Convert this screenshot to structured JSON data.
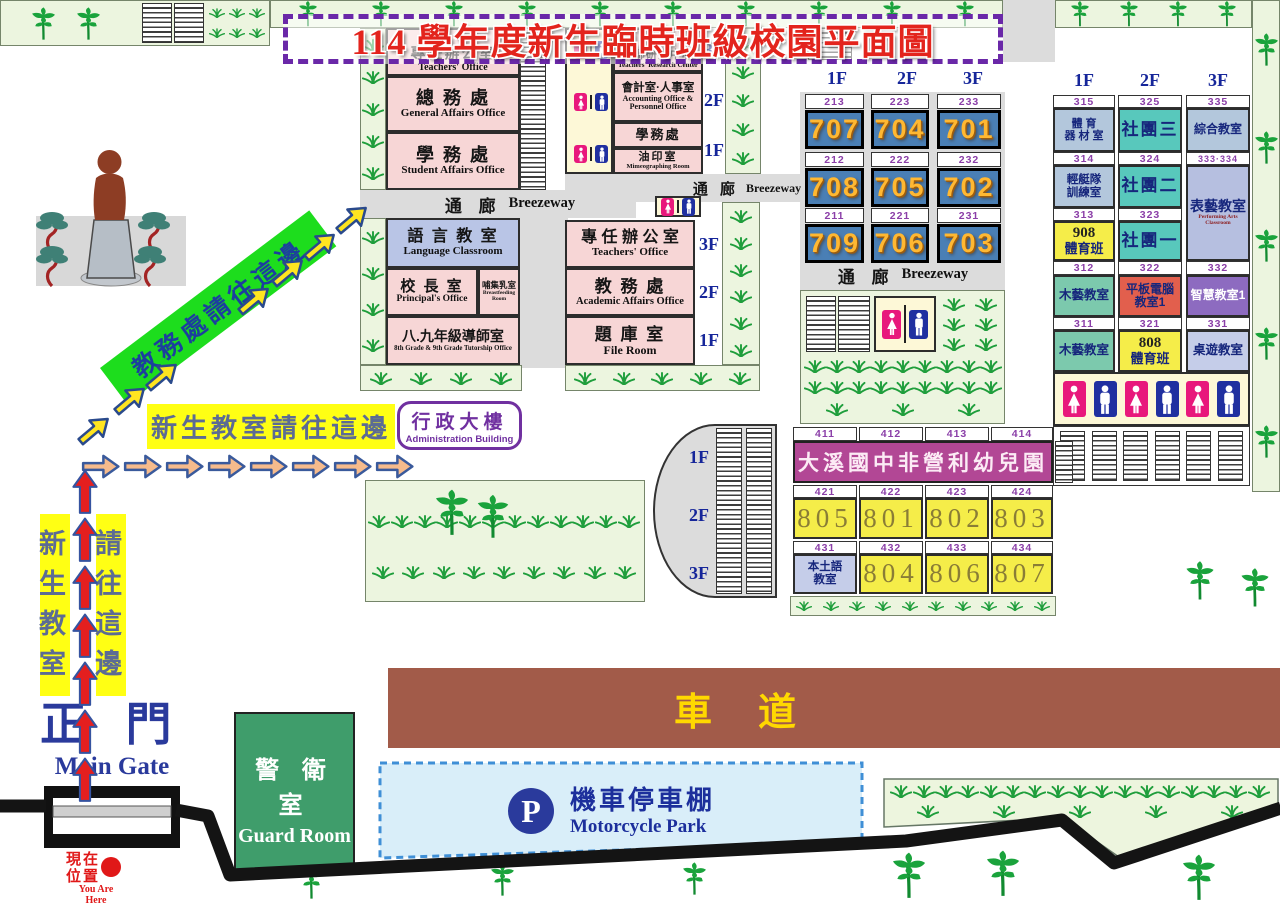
{
  "title": "114 學年度新生臨時班級校園平面圖",
  "corridor": {
    "zh": "通 廊",
    "en": "Breezeway"
  },
  "colors": {
    "title_red": "#e3241d",
    "title_border_purple": "#6a28a8",
    "room_pink": "#f7d6d6",
    "room_periwinkle": "#b9c5e6",
    "lawn_green": "#ecf5df",
    "grass_green": "#1f9e3c",
    "corridor_gray": "#dcdcdc",
    "class_cell_blue": "#4a7fb5",
    "class_cell_number_orange": "#ffb832",
    "room_number_purple": "#8b3fa8",
    "floor_label_navy": "#16269a",
    "cell_teal": "#58c8bc",
    "cell_bluegray": "#b3c7dc",
    "cell_yellow": "#f5ed49",
    "cell_green": "#7cc9ad",
    "cell_red": "#e25f4d",
    "cell_purple": "#8d6bc0",
    "cell_lavender": "#c5cde9",
    "kindergarten_purple": "#b24795",
    "guard_green": "#3f9d6b",
    "road_brown": "#a25b49",
    "road_text_yellow": "#ffd800",
    "park_bg_blue": "#d9eef9",
    "park_border_blue": "#3f8fd6",
    "park_text_navy": "#1c2f9c",
    "banner_green": "#1ddd1d",
    "banner_yellow": "#ffff14",
    "wc_female_pink": "#e8187c",
    "wc_male_blue": "#2030a0",
    "arrow_red": "#e41f1f",
    "arrow_orange": "#f6bb8c",
    "arrow_yellow": "#ffe520",
    "you_are_here_red": "#e01818"
  },
  "buildingA": {
    "r1": {
      "zh": "專任辦公室",
      "en": "Teachers' Office"
    },
    "r2": {
      "zh": "總 務 處",
      "en": "General Affairs Office"
    },
    "r3": {
      "zh": "學 務 處",
      "en": "Student Affairs Office"
    }
  },
  "buildingC": {
    "r1": {
      "zh": "教師研究中心",
      "en": "Teachers' Research Center"
    },
    "r2": {
      "zh": "會計室·人事室",
      "en": "Accounting Office & Personnel Office"
    },
    "r3": {
      "zh": "學務處"
    },
    "r4": {
      "zh": "油印室",
      "en": "Mimeographing Room"
    },
    "floors": [
      "3F",
      "2F",
      "1F"
    ]
  },
  "buildingB": {
    "r1": {
      "zh": "語 言 教 室",
      "en": "Language Classroom"
    },
    "r2": {
      "zh": "校 長 室",
      "en": "Principal's Office"
    },
    "r3": {
      "zh": "哺集乳室",
      "en": "Breastfeeding Room"
    },
    "r4": {
      "zh": "八.九年級導師室",
      "en": "8th Grade & 9th Grade Tutorship Office"
    }
  },
  "buildingD": {
    "r1": {
      "zh": "專 任 辦 公 室",
      "en": "Teachers' Office"
    },
    "r2": {
      "zh": "教 務 處",
      "en": "Academic Affairs Office"
    },
    "r3": {
      "zh": "題 庫 室",
      "en": "File Room"
    },
    "floors": [
      "3F",
      "2F",
      "1F"
    ]
  },
  "grid7": {
    "headers": [
      "1F",
      "2F",
      "3F"
    ],
    "rows": [
      [
        {
          "num": "213",
          "cls": "707"
        },
        {
          "num": "223",
          "cls": "704"
        },
        {
          "num": "233",
          "cls": "701"
        }
      ],
      [
        {
          "num": "212",
          "cls": "708"
        },
        {
          "num": "222",
          "cls": "705"
        },
        {
          "num": "232",
          "cls": "702"
        }
      ],
      [
        {
          "num": "211",
          "cls": "709"
        },
        {
          "num": "221",
          "cls": "706"
        },
        {
          "num": "231",
          "cls": "703"
        }
      ]
    ]
  },
  "buildingE": {
    "headers": [
      "1F",
      "2F",
      "3F"
    ],
    "nums": {
      "n1": [
        "315",
        "325",
        "335"
      ],
      "n2": [
        "314",
        "324",
        "333·334"
      ],
      "n3": [
        "313",
        "323"
      ],
      "n4": [
        "312",
        "322",
        "332"
      ],
      "n5": [
        "311",
        "321",
        "331"
      ]
    },
    "cells": {
      "equipment": "體 育\n器 材 室",
      "club3": "社團三",
      "multi": "綜合教室",
      "canoe": "輕艇隊\n訓練室",
      "club2": "社團二",
      "perf": {
        "zh": "表藝教室",
        "en": "Performing Arts Classroom"
      },
      "pe908": {
        "num": "908",
        "zh": "體育班"
      },
      "club1": "社團一",
      "wood1": "木藝教室",
      "tablet": "平板電腦\n教室1",
      "smart": "智慧教室1",
      "wood2": "木藝教室",
      "pe808": {
        "num": "808",
        "zh": "體育班"
      },
      "board": "桌遊教室"
    }
  },
  "buildingF": {
    "floors": [
      "1F",
      "2F",
      "3F"
    ],
    "nums": {
      "n1": [
        "411",
        "412",
        "413",
        "414"
      ],
      "n2": [
        "421",
        "422",
        "423",
        "424"
      ],
      "n3": [
        "431",
        "432",
        "433",
        "434"
      ]
    },
    "kindergarten": "大溪國中非營利幼兒園",
    "row2": [
      "805",
      "801",
      "802",
      "803"
    ],
    "local_lang": "本土語\n教室",
    "row3": [
      "804",
      "806",
      "807"
    ]
  },
  "signs": {
    "to_academic": "教務處請往這邊",
    "to_freshman": "新生教室請往這邊",
    "vertical_left": "新生教室",
    "vertical_right": "請往這邊",
    "admin": {
      "zh": "行政大樓",
      "en": "Administration Building"
    },
    "gate": {
      "zh": "正 門",
      "en": "Main Gate"
    },
    "guard": {
      "zh": "警 衛 室",
      "en": "Guard Room"
    },
    "road": "車道",
    "park": {
      "icon": "P",
      "zh": "機車停車棚",
      "en": "Motorcycle Park"
    },
    "here": {
      "zh": "現在\n位置",
      "en": "You Are\nHere"
    }
  }
}
